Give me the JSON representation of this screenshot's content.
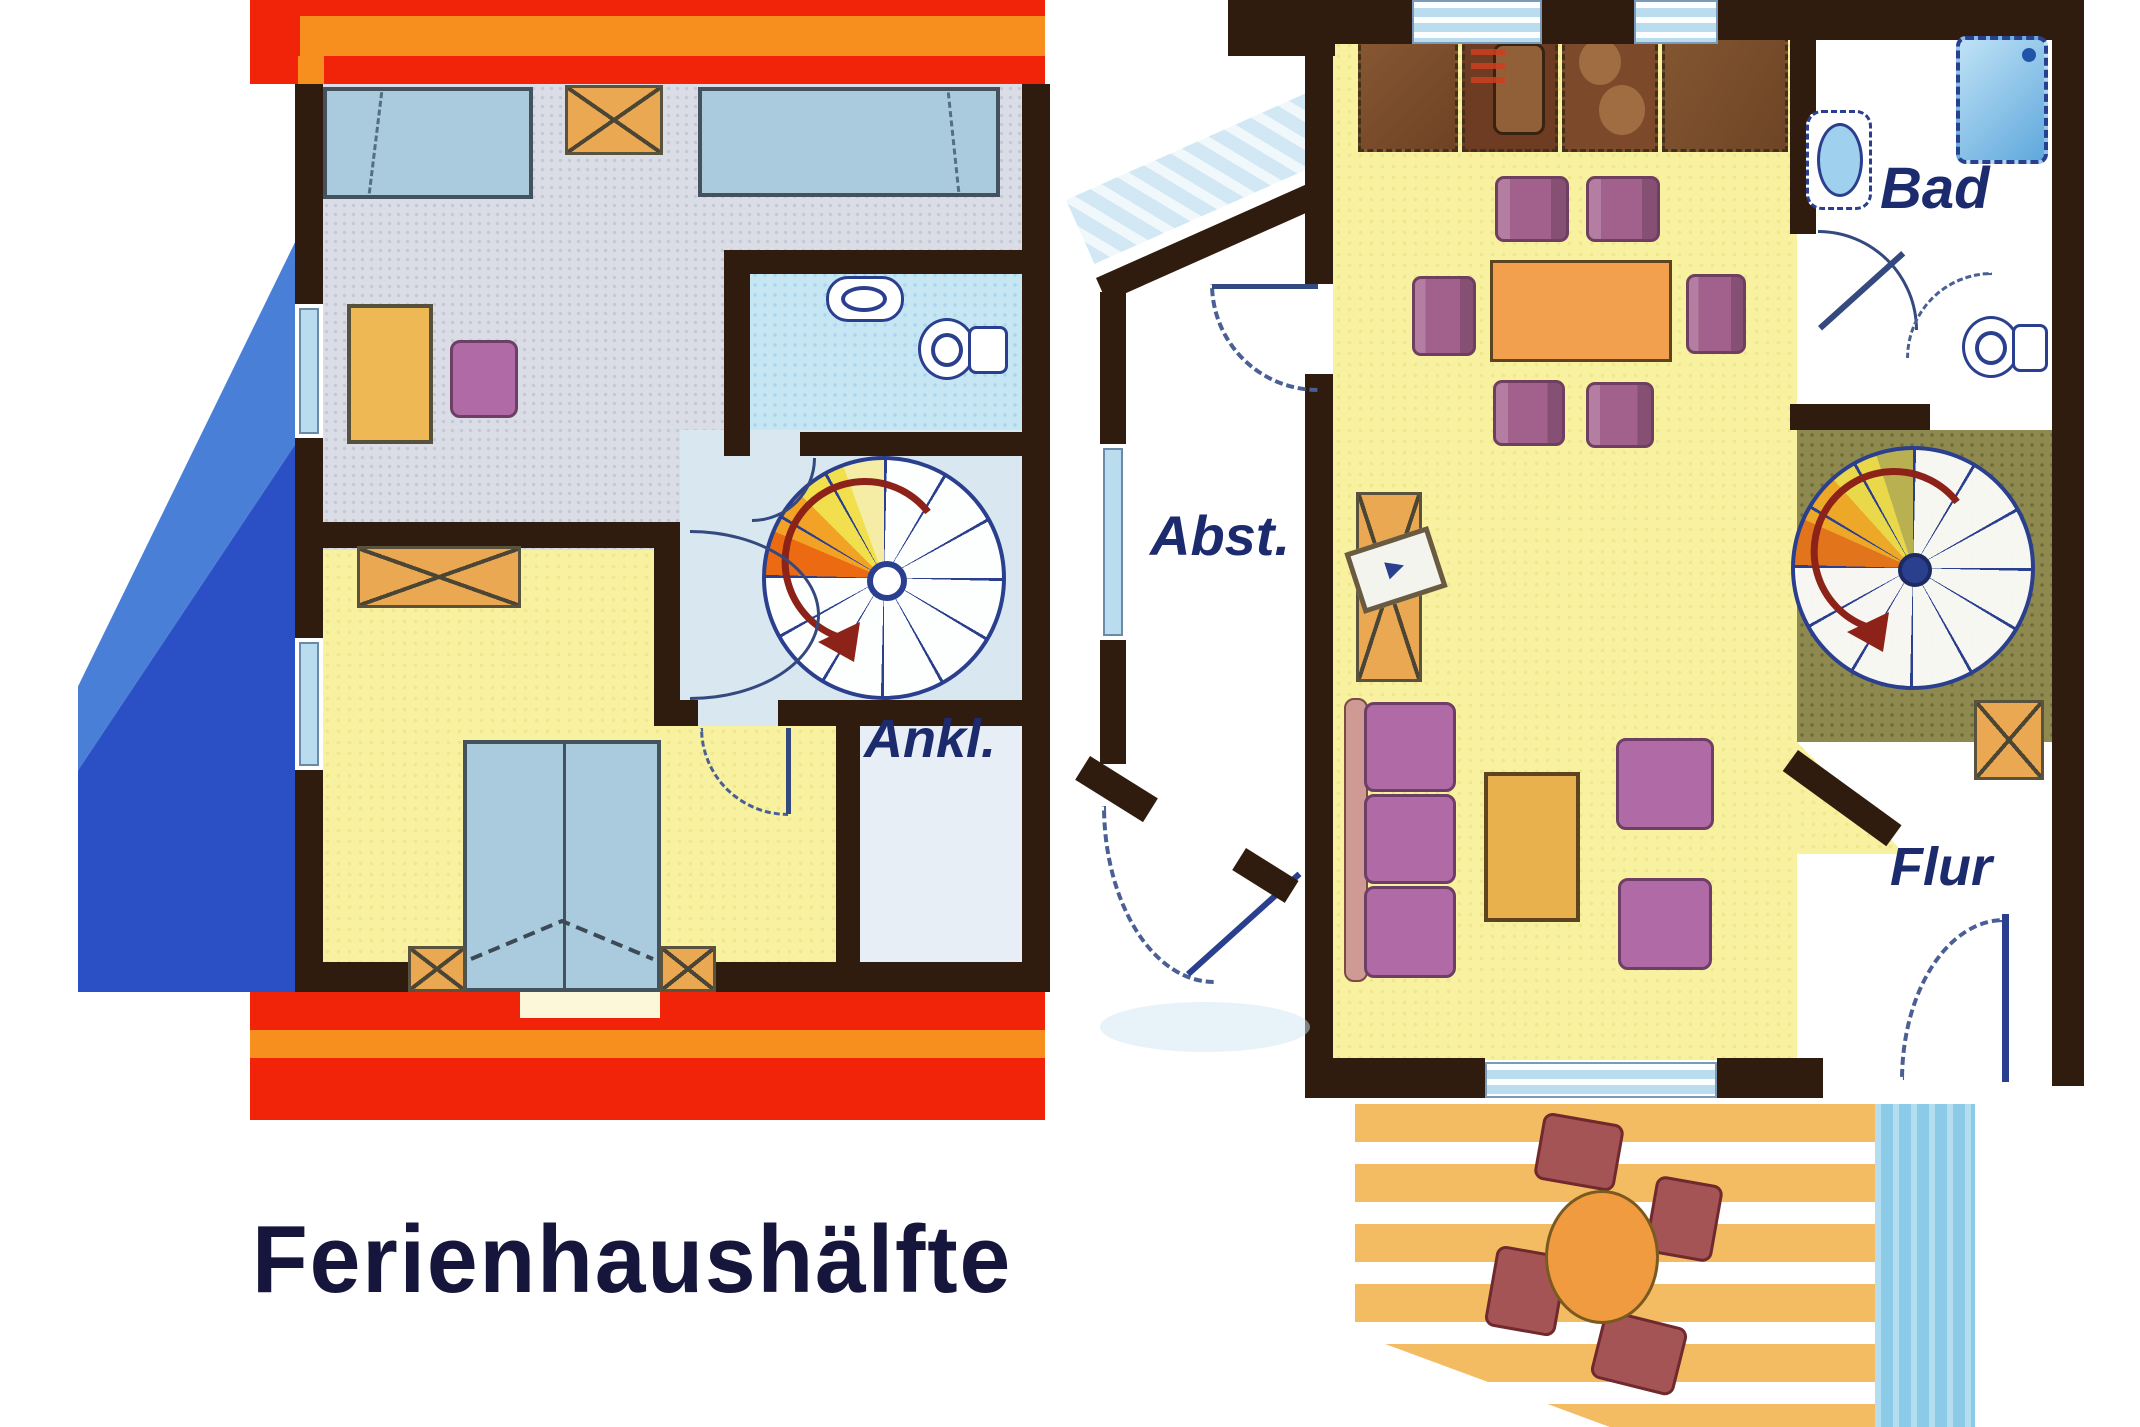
{
  "title": "Ferienhaushälfte",
  "labels": {
    "bathroom": "Bad",
    "storage": "Abst.",
    "dressing": "Ankl.",
    "hallway": "Flur"
  },
  "colors": {
    "roof_red": "#f12309",
    "roof_orange": "#f78f1e",
    "wall": "#2f1c0e",
    "label_navy": "#1c2a6e",
    "floor_yellow": "#f7f1a0",
    "bath_blue": "#c6e6f4",
    "hall_blue": "#d9e7f0",
    "bed_blue": "#a9cbdd",
    "furniture_orange": "#e9a851",
    "sofa_purple": "#b06aa5",
    "chair_mauve": "#a2618c",
    "table_orange": "#f2a04e",
    "stair_olive": "#8e894e",
    "gable_light": "#4a7fd8",
    "gable_dark": "#2b4fc4",
    "water_blue": "#8ccbe8",
    "terrace_tan": "#f3bb62",
    "line_navy": "#2a3f8e",
    "arrow_red": "#8c2218",
    "shade_blue": "#cfe7f4"
  }
}
